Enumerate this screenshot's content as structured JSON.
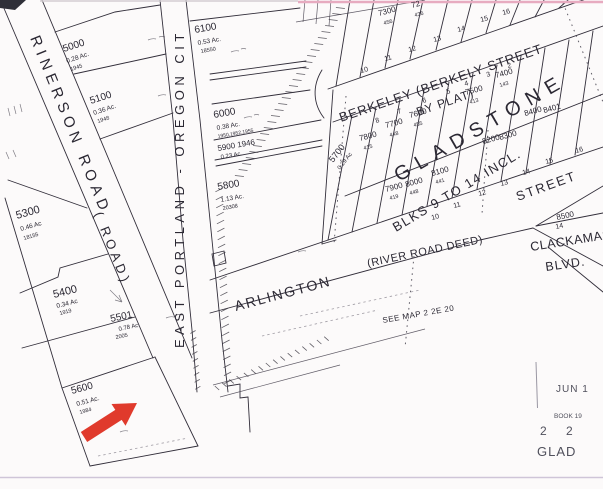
{
  "colors": {
    "ink": "#2b2833",
    "stamp": "#50505c",
    "arrow_red": "#e03a2c",
    "scan_pink": "#e7abc0",
    "scan_gray": "#cfc5d8"
  },
  "labels": [
    {
      "n": "road-label-rinerson",
      "t": "RINERSON  ROAD",
      "x": 30,
      "y": 38,
      "r": 68,
      "s": 15,
      "ls": 5
    },
    {
      "n": "road-label-road-paren",
      "t": "( ROAD)",
      "x": 94,
      "y": 214,
      "r": 68,
      "s": 13,
      "ls": 4
    },
    {
      "n": "road-label-east-portland-oregon-city",
      "t": "EAST  PORTLAND - OREGON  CIT",
      "x": 184,
      "y": 348,
      "r": -90,
      "s": 13,
      "ls": 4.5
    },
    {
      "n": "street-label-berkeley",
      "t": "BERKELEY (BERKELY   STREET",
      "x": 341,
      "y": 122,
      "r": -19,
      "s": 13,
      "ls": 1
    },
    {
      "n": "street-label-by-plat",
      "t": "BY PLAT)",
      "x": 418,
      "y": 116,
      "r": -19,
      "s": 12,
      "ls": 1
    },
    {
      "n": "street-label-arlington",
      "t": "ARLINGTON",
      "x": 236,
      "y": 311,
      "r": -15,
      "s": 14,
      "ls": 2
    },
    {
      "n": "street-label-river-road-deed",
      "t": "(RIVER ROAD DEED)",
      "x": 368,
      "y": 267,
      "r": -12,
      "s": 11,
      "ls": 0.5
    },
    {
      "n": "street-label-street",
      "t": "STREET",
      "x": 518,
      "y": 201,
      "r": -20,
      "s": 13,
      "ls": 2
    },
    {
      "n": "street-label-clackamas",
      "t": "CLACKAMAS",
      "x": 531,
      "y": 251,
      "r": -9,
      "s": 12.5,
      "ls": 0.5
    },
    {
      "n": "street-label-blvd",
      "t": "BLVD.",
      "x": 546,
      "y": 271,
      "r": -8,
      "s": 12.5,
      "ls": 1
    },
    {
      "n": "note-see-map",
      "t": "SEE  MAP  2   2E  20",
      "x": 383,
      "y": 323,
      "r": -10,
      "s": 8,
      "ls": 0.5
    },
    {
      "n": "plat-name-gladstone",
      "t": "GLADSTONE",
      "x": 399,
      "y": 182,
      "r": -30,
      "s": 20,
      "ls": 8
    },
    {
      "n": "plat-note-blocks",
      "t": "BLKS 9 TO 14 INCL.",
      "x": 396,
      "y": 232,
      "r": -31,
      "s": 13,
      "ls": 1.5
    },
    {
      "n": "parcel-5000-number",
      "t": "5000",
      "x": 64,
      "y": 52,
      "r": -18,
      "s": 10
    },
    {
      "n": "parcel-5000-area",
      "t": "0.28 Ac.",
      "x": 67,
      "y": 63,
      "r": -18,
      "s": 6.5
    },
    {
      "n": "parcel-5000-ref",
      "t": "1945",
      "x": 71,
      "y": 71,
      "r": -18,
      "s": 5.5
    },
    {
      "n": "parcel-5100-number",
      "t": "5100",
      "x": 91,
      "y": 104,
      "r": -18,
      "s": 10
    },
    {
      "n": "parcel-5100-area",
      "t": "0.36 Ac.",
      "x": 94,
      "y": 115,
      "r": -18,
      "s": 6.5
    },
    {
      "n": "parcel-5100-ref",
      "t": "1948",
      "x": 98,
      "y": 123,
      "r": -18,
      "s": 5.5
    },
    {
      "n": "parcel-5300-number",
      "t": "5300",
      "x": 17,
      "y": 219,
      "r": -16,
      "s": 11
    },
    {
      "n": "parcel-5300-area",
      "t": "0.46 Ac",
      "x": 21,
      "y": 231,
      "r": -16,
      "s": 6.5
    },
    {
      "n": "parcel-5300-ref",
      "t": "18155",
      "x": 24,
      "y": 240,
      "r": -16,
      "s": 5.5
    },
    {
      "n": "parcel-5400-number",
      "t": "5400",
      "x": 54,
      "y": 298,
      "r": -14,
      "s": 11
    },
    {
      "n": "parcel-5400-area",
      "t": "0.34 Ac",
      "x": 57,
      "y": 308,
      "r": -14,
      "s": 6.5
    },
    {
      "n": "parcel-5400-ref",
      "t": "1919",
      "x": 60,
      "y": 315,
      "r": -14,
      "s": 5.5
    },
    {
      "n": "parcel-5501-number",
      "t": "5501",
      "x": 111,
      "y": 322,
      "r": -12,
      "s": 10
    },
    {
      "n": "parcel-5501-area",
      "t": "0.78 Ac",
      "x": 119,
      "y": 331,
      "r": -12,
      "s": 6
    },
    {
      "n": "parcel-5501-ref",
      "t": "2005",
      "x": 116,
      "y": 339,
      "r": -12,
      "s": 5.5
    },
    {
      "n": "parcel-5600-number",
      "t": "5600",
      "x": 72,
      "y": 394,
      "r": -15,
      "s": 10
    },
    {
      "n": "parcel-5600-area",
      "t": "0.51 Ac.",
      "x": 77,
      "y": 406,
      "r": -15,
      "s": 6.5
    },
    {
      "n": "parcel-5600-ref",
      "t": "1984",
      "x": 80,
      "y": 414,
      "r": -15,
      "s": 5.5
    },
    {
      "n": "parcel-5700-number",
      "t": "5700",
      "x": 333,
      "y": 163,
      "r": -52,
      "s": 9
    },
    {
      "n": "parcel-5700-area",
      "t": "0.29 Ac",
      "x": 340,
      "y": 170,
      "r": -52,
      "s": 6
    },
    {
      "n": "parcel-5800-number",
      "t": "5800",
      "x": 218,
      "y": 190,
      "r": -10,
      "s": 10
    },
    {
      "n": "parcel-5800-area",
      "t": "1.13 Ac.",
      "x": 221,
      "y": 202,
      "r": -10,
      "s": 6.5
    },
    {
      "n": "parcel-5800-ref",
      "t": "20308",
      "x": 223,
      "y": 210,
      "r": -10,
      "s": 5.5
    },
    {
      "n": "parcel-5900-number",
      "t": "5900  1946",
      "x": 218,
      "y": 151,
      "r": -10,
      "s": 8
    },
    {
      "n": "parcel-5900-area",
      "t": "0.23 Ac.",
      "x": 221,
      "y": 159,
      "r": -10,
      "s": 6
    },
    {
      "n": "parcel-6000-number",
      "t": "6000",
      "x": 214,
      "y": 118,
      "r": -10,
      "s": 10
    },
    {
      "n": "parcel-6000-area",
      "t": "0.38 Ac.",
      "x": 217,
      "y": 130,
      "r": -10,
      "s": 6.5
    },
    {
      "n": "parcel-6000-ref",
      "t": "1950,1952,1955",
      "x": 218,
      "y": 138,
      "r": -10,
      "s": 5
    },
    {
      "n": "parcel-6100-number",
      "t": "6100",
      "x": 195,
      "y": 33,
      "r": -10,
      "s": 10
    },
    {
      "n": "parcel-6100-area",
      "t": "0.53 Ac.",
      "x": 198,
      "y": 45,
      "r": -10,
      "s": 6.5
    },
    {
      "n": "parcel-6100-ref",
      "t": "18550",
      "x": 201,
      "y": 53,
      "r": -10,
      "s": 5.5
    },
    {
      "n": "lot-7300-number",
      "t": "7300",
      "x": 379,
      "y": 16,
      "r": -15,
      "s": 8
    },
    {
      "n": "lot-7300-ref",
      "t": "456",
      "x": 384,
      "y": 25,
      "r": -15,
      "s": 5.5
    },
    {
      "n": "lot-7200-number",
      "t": "72",
      "x": 412,
      "y": 8,
      "r": -15,
      "s": 8
    },
    {
      "n": "lot-7200-ref",
      "t": "436",
      "x": 415,
      "y": 17,
      "r": -15,
      "s": 5.5
    },
    {
      "n": "blklot-north-10",
      "t": "10",
      "x": 361,
      "y": 73,
      "r": -15,
      "s": 7
    },
    {
      "n": "blklot-north-11",
      "t": "11",
      "x": 385,
      "y": 61,
      "r": -15,
      "s": 7
    },
    {
      "n": "blklot-north-12",
      "t": "12",
      "x": 409,
      "y": 52,
      "r": -15,
      "s": 7
    },
    {
      "n": "blklot-north-13",
      "t": "13",
      "x": 434,
      "y": 42,
      "r": -15,
      "s": 7
    },
    {
      "n": "blklot-north-14",
      "t": "14",
      "x": 458,
      "y": 32,
      "r": -15,
      "s": 7
    },
    {
      "n": "blklot-north-15",
      "t": "15",
      "x": 481,
      "y": 22,
      "r": -15,
      "s": 7
    },
    {
      "n": "blklot-north-16",
      "t": "16",
      "x": 503,
      "y": 15,
      "r": -15,
      "s": 7
    },
    {
      "n": "lot-7800-number",
      "t": "7800",
      "x": 360,
      "y": 141,
      "r": -15,
      "s": 8
    },
    {
      "n": "lot-7800-ref",
      "t": "415",
      "x": 364,
      "y": 150,
      "r": -15,
      "s": 5.5
    },
    {
      "n": "lot-7700-number",
      "t": "7700",
      "x": 386,
      "y": 128,
      "r": -15,
      "s": 8
    },
    {
      "n": "lot-7700-ref",
      "t": "448",
      "x": 390,
      "y": 137,
      "r": -15,
      "s": 5.5
    },
    {
      "n": "lot-7600-number",
      "t": "7600",
      "x": 410,
      "y": 118,
      "r": -15,
      "s": 8
    },
    {
      "n": "lot-7600-ref",
      "t": "455",
      "x": 414,
      "y": 127,
      "r": -15,
      "s": 5.5
    },
    {
      "n": "lot-7500-number",
      "t": "7500",
      "x": 466,
      "y": 95,
      "r": -15,
      "s": 8
    },
    {
      "n": "lot-7500-ref",
      "t": "413",
      "x": 470,
      "y": 104,
      "r": -15,
      "s": 5.5
    },
    {
      "n": "lot-7400-number",
      "t": "7400",
      "x": 496,
      "y": 78,
      "r": -15,
      "s": 8
    },
    {
      "n": "lot-7400-ref",
      "t": "143",
      "x": 500,
      "y": 87,
      "r": -15,
      "s": 5.5
    },
    {
      "n": "blklot-south-8",
      "t": "8",
      "x": 376,
      "y": 123,
      "r": -15,
      "s": 7
    },
    {
      "n": "blklot-south-7",
      "t": "7",
      "x": 398,
      "y": 114,
      "r": -15,
      "s": 7
    },
    {
      "n": "blklot-south-6",
      "t": "6",
      "x": 423,
      "y": 103,
      "r": -15,
      "s": 7
    },
    {
      "n": "blklot-south-5",
      "t": "5",
      "x": 447,
      "y": 94,
      "r": -15,
      "s": 7
    },
    {
      "n": "blklot-south-4",
      "t": "4",
      "x": 465,
      "y": 86,
      "r": -15,
      "s": 7
    },
    {
      "n": "blklot-south-3",
      "t": "3",
      "x": 487,
      "y": 77,
      "r": -15,
      "s": 7
    },
    {
      "n": "blklot-south-2",
      "t": "2",
      "x": 508,
      "y": 68,
      "r": -15,
      "s": 7
    },
    {
      "n": "lot-7900-number",
      "t": "7900",
      "x": 386,
      "y": 192,
      "r": -15,
      "s": 8
    },
    {
      "n": "lot-7900-ref",
      "t": "419",
      "x": 390,
      "y": 200,
      "r": -15,
      "s": 5.5
    },
    {
      "n": "lot-8000-number",
      "t": "8000",
      "x": 406,
      "y": 187,
      "r": -15,
      "s": 8
    },
    {
      "n": "lot-8000-ref",
      "t": "448",
      "x": 410,
      "y": 195,
      "r": -15,
      "s": 5.5
    },
    {
      "n": "lot-8100-number",
      "t": "8100",
      "x": 432,
      "y": 176,
      "r": -15,
      "s": 8
    },
    {
      "n": "lot-8100-ref",
      "t": "441",
      "x": 436,
      "y": 184,
      "r": -15,
      "s": 5.5
    },
    {
      "n": "lot-8200-number",
      "t": "8200",
      "x": 483,
      "y": 144,
      "r": -15,
      "s": 8
    },
    {
      "n": "lot-8300-number",
      "t": "8300",
      "x": 500,
      "y": 140,
      "r": -15,
      "s": 8
    },
    {
      "n": "blklot-row2-10",
      "t": "10",
      "x": 432,
      "y": 220,
      "r": -15,
      "s": 7
    },
    {
      "n": "blklot-row2-11",
      "t": "11",
      "x": 454,
      "y": 208,
      "r": -15,
      "s": 7
    },
    {
      "n": "blklot-row2-12",
      "t": "12",
      "x": 479,
      "y": 196,
      "r": -15,
      "s": 7
    },
    {
      "n": "blklot-row2-13",
      "t": "13",
      "x": 501,
      "y": 186,
      "r": -15,
      "s": 7
    },
    {
      "n": "blklot-row2-14",
      "t": "14",
      "x": 523,
      "y": 175,
      "r": -15,
      "s": 7
    },
    {
      "n": "blklot-row2-15",
      "t": "15",
      "x": 546,
      "y": 164,
      "r": -15,
      "s": 7
    },
    {
      "n": "blklot-row2-16",
      "t": "16",
      "x": 576,
      "y": 153,
      "r": -15,
      "s": 7
    },
    {
      "n": "lot-8400-number",
      "t": "8400",
      "x": 525,
      "y": 116,
      "r": -15,
      "s": 8
    },
    {
      "n": "lot-8401-number",
      "t": "8401",
      "x": 544,
      "y": 113,
      "r": -15,
      "s": 8
    },
    {
      "n": "lot-8500-number",
      "t": "8500",
      "x": 557,
      "y": 220,
      "r": -12,
      "s": 8
    },
    {
      "n": "lot-8500-lot",
      "t": "14",
      "x": 556,
      "y": 229,
      "r": -12,
      "s": 7
    },
    {
      "n": "stamp-date",
      "t": "JUN 1",
      "x": 556,
      "y": 392,
      "r": 0,
      "s": 10,
      "ls": 1,
      "c": "stamp"
    },
    {
      "n": "stamp-book",
      "t": "BOOK 19",
      "x": 554,
      "y": 418,
      "r": 0,
      "s": 6.5,
      "c": "stamp"
    },
    {
      "n": "stamp-number-left",
      "t": "2",
      "x": 540,
      "y": 435,
      "r": 0,
      "s": 12,
      "c": "stamp"
    },
    {
      "n": "stamp-number-right",
      "t": "2",
      "x": 566,
      "y": 435,
      "r": 0,
      "s": 12,
      "c": "stamp"
    },
    {
      "n": "stamp-glad",
      "t": "GLAD",
      "x": 537,
      "y": 456,
      "r": 0,
      "s": 13,
      "ls": 1,
      "c": "stamp"
    }
  ]
}
